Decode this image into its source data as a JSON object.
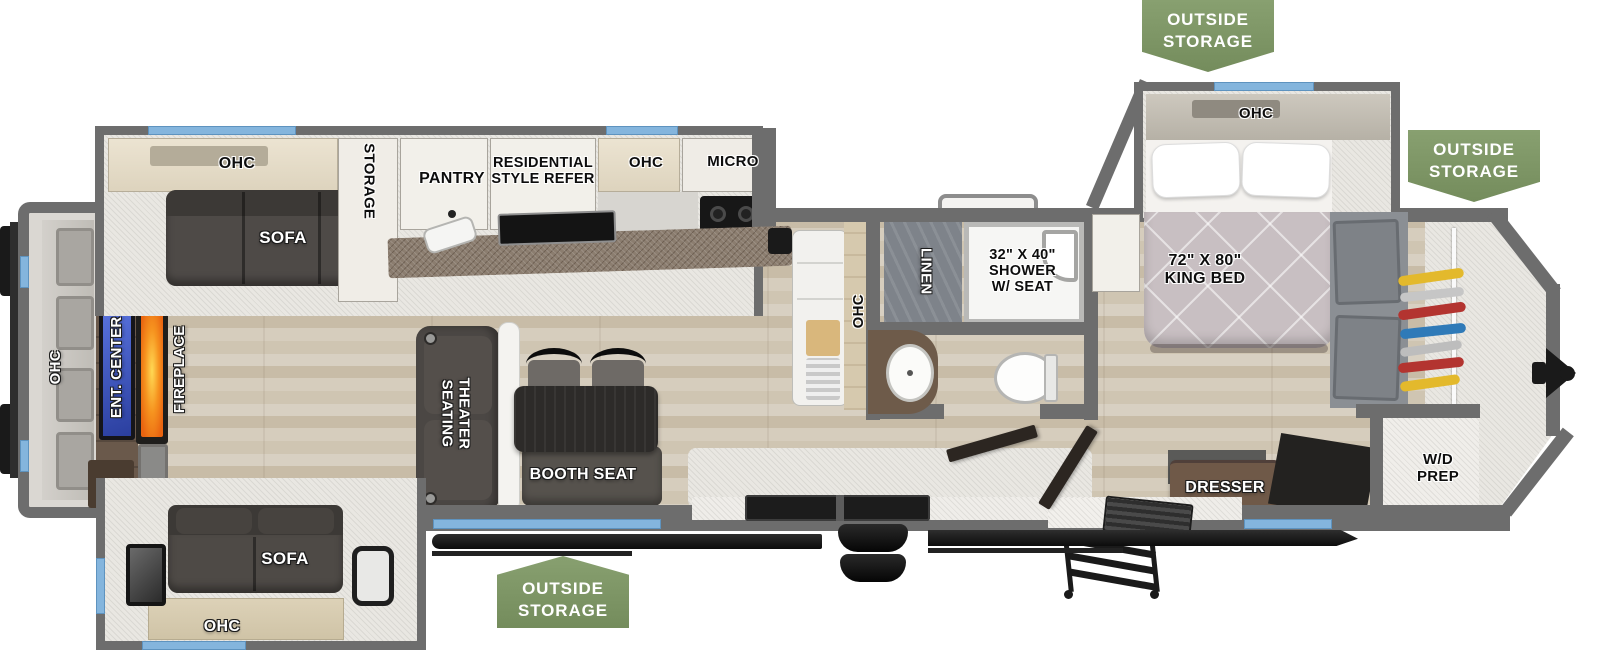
{
  "colors": {
    "badge_green": "#7b9164",
    "accent_blue": "#84b5dd",
    "wall_gray": "#6d6d6d",
    "fireplace_orange": "#f08a1e",
    "tv_screen_blue": "#4662cf"
  },
  "badges": [
    {
      "id": "top-right",
      "line1": "OUTSIDE",
      "line2": "STORAGE"
    },
    {
      "id": "front-right",
      "line1": "OUTSIDE",
      "line2": "STORAGE"
    },
    {
      "id": "bottom-center",
      "line1": "OUTSIDE",
      "line2": "STORAGE"
    }
  ],
  "rear_wall": {
    "ohc": "OHC",
    "ent_center": "ENT. CENTER",
    "fireplace": "FIREPLACE"
  },
  "top_slide": {
    "ohc": "OHC",
    "sofa": "SOFA",
    "storage": "STORAGE"
  },
  "kitchen": {
    "pantry": "PANTRY",
    "refer_line1": "RESIDENTIAL",
    "refer_line2": "STYLE REFER",
    "ohc": "OHC",
    "micro": "MICRO",
    "island_ohc": "OHC"
  },
  "living": {
    "theater_line1": "THEATER",
    "theater_line2": "SEATING",
    "booth_seat": "BOOTH SEAT"
  },
  "bottom_slide": {
    "sofa": "SOFA",
    "ohc": "OHC"
  },
  "bathroom": {
    "linen": "LINEN",
    "shower_line1": "32\" X 40\"",
    "shower_line2": "SHOWER",
    "shower_line3": "W/ SEAT"
  },
  "bedroom": {
    "ohc": "OHC",
    "bed_line1": "72\" X 80\"",
    "bed_line2": "KING BED",
    "dresser": "DRESSER"
  },
  "front": {
    "wd_line1": "W/D",
    "wd_line2": "PREP"
  }
}
